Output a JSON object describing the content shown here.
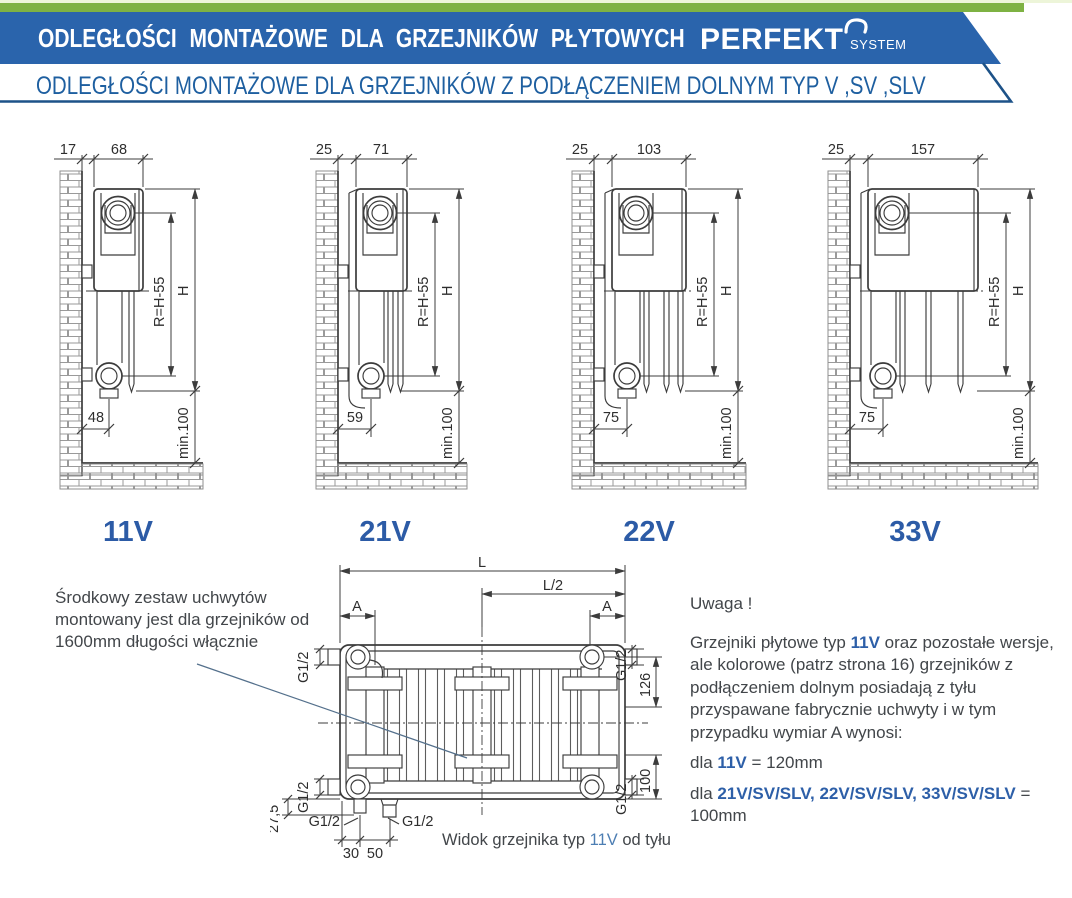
{
  "header": {
    "band1": "ODLEGŁOŚCI MONTAŻOWE DLA GRZEJNIKÓW PŁYTOWYCH",
    "brand": "PERFEKT",
    "brand_sub": "SYSTEM",
    "band2": "ODLEGŁOŚCI MONTAŻOWE DLA GRZEJNIKÓW Z PODŁĄCZENIEM DOLNYM TYP V ,SV ,SLV"
  },
  "colors": {
    "green_strip": "#7eb243",
    "banner_blue": "#2a64ac",
    "banner2_text": "#1e5fa0",
    "type_label_blue": "#2c5ba6",
    "caption_blue": "#4d7eb3",
    "drawing_stroke": "#3c3c3c"
  },
  "diagrams": [
    {
      "label": "11V",
      "wall_gap": "17",
      "depth": "68",
      "r": "R=H-55",
      "h": "H",
      "bottom": "48",
      "min": "min.100"
    },
    {
      "label": "21V",
      "wall_gap": "25",
      "depth": "71",
      "r": "R=H-55",
      "h": "H",
      "bottom": "59",
      "min": "min.100"
    },
    {
      "label": "22V",
      "wall_gap": "25",
      "depth": "103",
      "r": "R=H-55",
      "h": "H",
      "bottom": "75",
      "min": "min.100"
    },
    {
      "label": "33V",
      "wall_gap": "25",
      "depth": "157",
      "r": "R=H-55",
      "h": "H",
      "bottom": "75",
      "min": "min.100"
    }
  ],
  "rear": {
    "L": "L",
    "L2": "L/2",
    "A_left": "A",
    "A_right": "A",
    "g12": "G1/2",
    "d126": "126",
    "d100": "100",
    "d27_5": "27,5",
    "d30": "30",
    "d50": "50",
    "caption_1": "Widok grzejnika typ ",
    "caption_type": "11V",
    "caption_2": " od tyłu"
  },
  "notes": {
    "left": "Środkowy zestaw uchwytów montowany jest dla grzejników od 1600mm długości włącznie",
    "warning_title": "Uwaga !",
    "p1a": "Grzejniki płytowe typ ",
    "p1b": "11V",
    "p1c": " oraz pozostałe wersje, ale kolorowe (patrz strona 16) grzejników z podłączeniem dolnym posiadają z tyłu przyspawane fabrycznie uchwyty i w tym przypadku wymiar A wynosi:",
    "p2a": "dla ",
    "p2b": "11V",
    "p2c": " = 120mm",
    "p3a": "dla ",
    "p3b": "21V/SV/SLV, 22V/SV/SLV, 33V/SV/SLV",
    "p3c": " = 100mm"
  }
}
